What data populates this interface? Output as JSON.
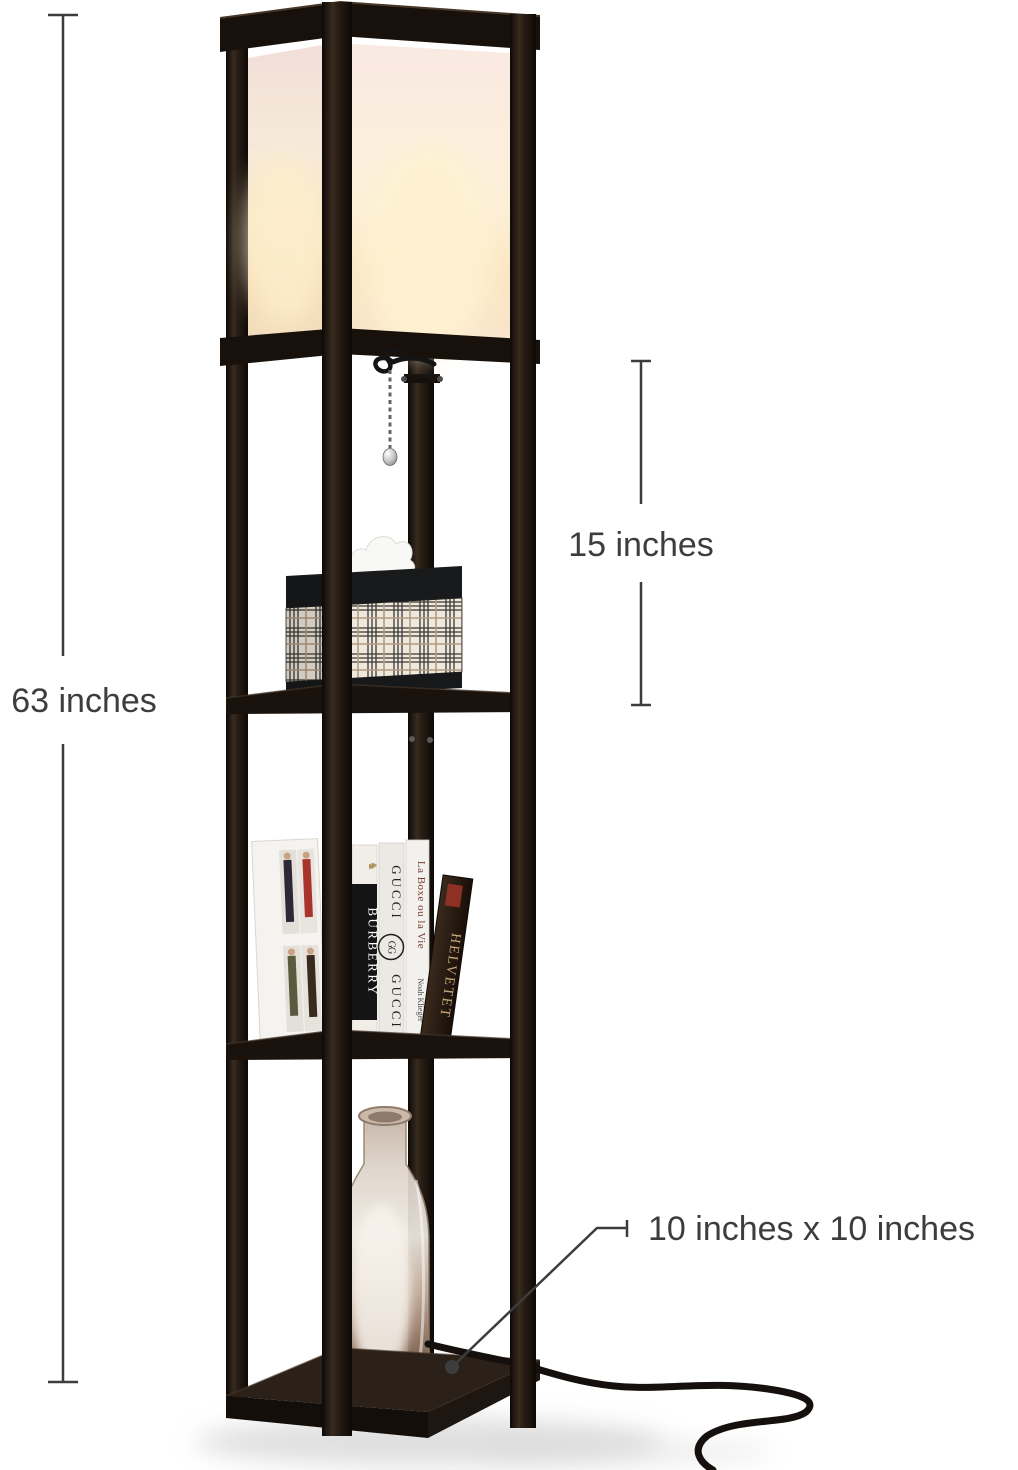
{
  "scene": {
    "type": "product photo with dimension callouts",
    "background": "#ffffff",
    "product": "etagere shelf floor lamp with lit shade, tissue box, books, and glass vase"
  },
  "annotations": {
    "height": {
      "label": "63 inches"
    },
    "section": {
      "label": "15 inches"
    },
    "base": {
      "label": "10 inches x 10 inches"
    },
    "text_color": "#3d3d3d"
  },
  "lamp": {
    "colors": {
      "frame": "#1d1610",
      "shade_glow": "#fbeed3",
      "shade_blush": "#f8e8e2",
      "plaid_background": "#efe8dc",
      "cord": "#17100c",
      "vase_glass": "#cdb6a4"
    },
    "books": [
      {
        "spine": "BURBERRY",
        "emblem": "♞"
      },
      {
        "spine": "GUCCI",
        "spine_bottom": "GUCCI",
        "logo": "GG"
      },
      {
        "spine": "La Boxe ou la Vie",
        "author": "Noah Klieger",
        "publisher_mark": "M"
      },
      {
        "spine": "HELVETET"
      }
    ]
  }
}
